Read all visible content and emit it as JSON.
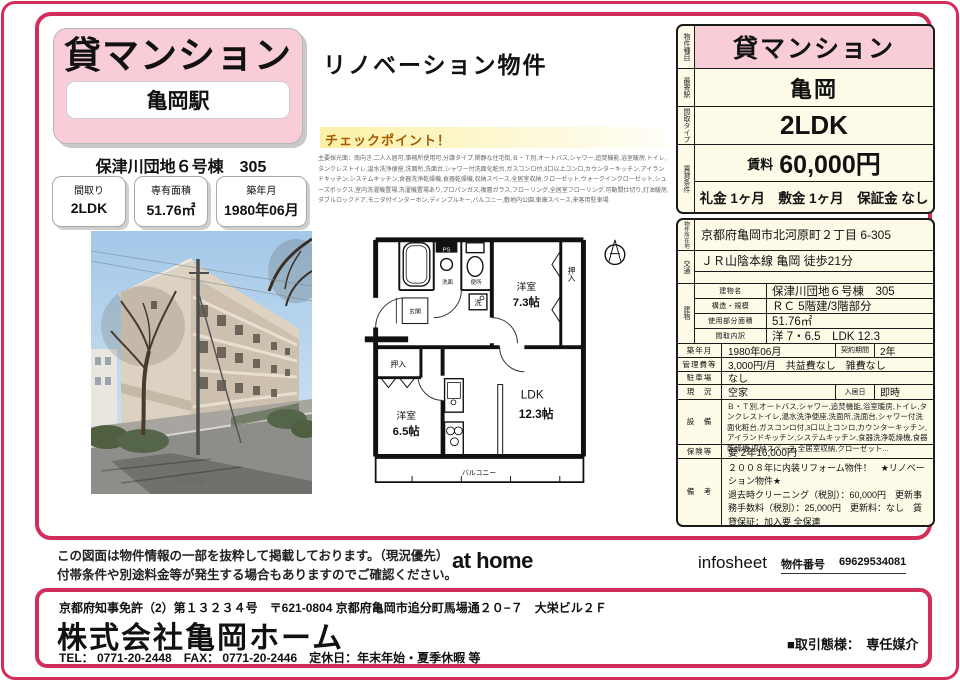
{
  "colors": {
    "accent": "#d22e5b",
    "title_pink": "#f8cdd8",
    "table_cream": "#fdfbe8",
    "checkpoint_band": "#fbf0a6",
    "checkpoint_text": "#a25b00"
  },
  "left": {
    "title": "貸マンション",
    "station": "亀岡駅",
    "property": "保津川団地６号棟　305",
    "specs": [
      {
        "label": "間取り",
        "value": "2LDK"
      },
      {
        "label": "専有面積",
        "value": "51.76㎡"
      },
      {
        "label": "築年月",
        "value": "1980年06月"
      }
    ]
  },
  "middle": {
    "reno_title": "リノベーション物件",
    "checkpoint_title": "チェックポイント！",
    "features": "主要採光面：南向き,二人入居可,事務所使用可,分譲タイプ,閑静な住宅街,Ｂ・Ｔ別,オートバス,シャワー,追焚機能,浴室暖房,トイレ,タンクレストイレ,温水洗浄便座,洗面所,洗面台,シャワー付洗面化粧台,ガスコンロ付,3口以上コンロ,カウンターキッチン,アイランドキッチン,システムキッチン,食器洗浄乾燥機,食器乾燥機,収納スペース,全居室収納,クローゼット,ウォークインクローゼット,シューズボックス,室内洗濯機置場,洗濯機置場あり,プロパンガス,複層ガラス,フローリング,全居室フローリング,可動間仕切り,灯油暖房,ダブルロックドア,モニタ付インターホン,ディンプルキー,バルコニー,敷地内公園,車庫スペース,来客用駐車場",
    "floorplan": {
      "room_a": "洋室",
      "room_a_size": "7.3帖",
      "room_b": "洋室",
      "room_b_size": "6.5帖",
      "ldk": "LDK",
      "ldk_size": "12.3帖",
      "closet_a": "押入",
      "closet_b": "押入",
      "balcony": "バルコニー",
      "entrance": "玄関",
      "ps": "PS",
      "washroom": "洗面",
      "toilet": "便所",
      "laundry": "洗"
    }
  },
  "summary": {
    "type_label": "物件種目",
    "type": "貸マンション",
    "station_label": "最寄駅",
    "station": "亀岡",
    "layout_label": "間取タイプ",
    "layout": "2LDK",
    "terms_label": "賃貸条件",
    "rent_label": "賃料",
    "rent": "60,000円",
    "fees": "礼金 1ヶ月　敷金 1ヶ月　保証金 なし"
  },
  "detail": {
    "address_label": "物件所在地",
    "address": "京都府亀岡市北河原町２丁目 6-305",
    "access_label": "交通",
    "access": "ＪＲ山陰本線 亀岡 徒歩21分",
    "building_label": "建物",
    "building_rows": [
      {
        "label": "建物名",
        "value": "保津川団地６号棟　305"
      },
      {
        "label": "構造・規模",
        "value": "ＲＣ 5階建/3階部分"
      },
      {
        "label": "使用部分面積",
        "value": "51.76㎡"
      },
      {
        "label": "間取内訳",
        "value": "洋 7・6.5　LDK 12.3"
      }
    ],
    "built_label": "築年月",
    "built": "1980年06月",
    "contract_label": "契約期間",
    "contract": "2年",
    "mgmt_label": "管理費等",
    "mgmt": "3,000円/月　共益費なし　雑費なし",
    "parking_label": "駐車場",
    "parking": "なし",
    "status_label": "現　況",
    "status": "空家",
    "movein_label": "入居日",
    "movein": "即時",
    "equip_label": "設　備",
    "equip": "Ｂ・Ｔ別,オートバス,シャワー,追焚機能,浴室暖房,トイレ,タンクレストイレ,温水洗浄便座,洗面所,洗面台,シャワー付洗面化粧台,ガスコンロ付,3口以上コンロ,カウンターキッチン,アイランドキッチン,システムキッチン,食器洗浄乾燥機,食器乾燥機,収納スペース,全居室収納,クローゼット...",
    "insurance_label": "保険等",
    "insurance": "要 2年16,000円",
    "remarks_label": "備　考",
    "remarks": "２００８年に内装リフォーム物件！　★リノベーション物件★\n退去時クリーニング（税別）：60,000円　更新事務手数料（税別）：25,000円　更新料：なし　賃貸保証：加入要 全保連"
  },
  "footer": {
    "disclaimer1": "この図面は物件情報の一部を抜粋して掲載しております。（現況優先）",
    "disclaimer2": "付帯条件や別途料金等が発生する場合もありますのでご確認ください。",
    "logo": "at home",
    "infosheet": "infosheet",
    "property_no_label": "物件番号",
    "property_no": "69629534081"
  },
  "company": {
    "license": "京都府知事免許（2）第１３２３４号　〒621-0804 京都府亀岡市追分町馬場通２０−７　大栄ビル２Ｆ",
    "name": "株式会社亀岡ホーム",
    "contact": "TEL： 0771-20-2448　FAX： 0771-20-2446　定休日：年末年始・夏季休暇 等",
    "transaction": "■取引態様：　専任媒介"
  }
}
